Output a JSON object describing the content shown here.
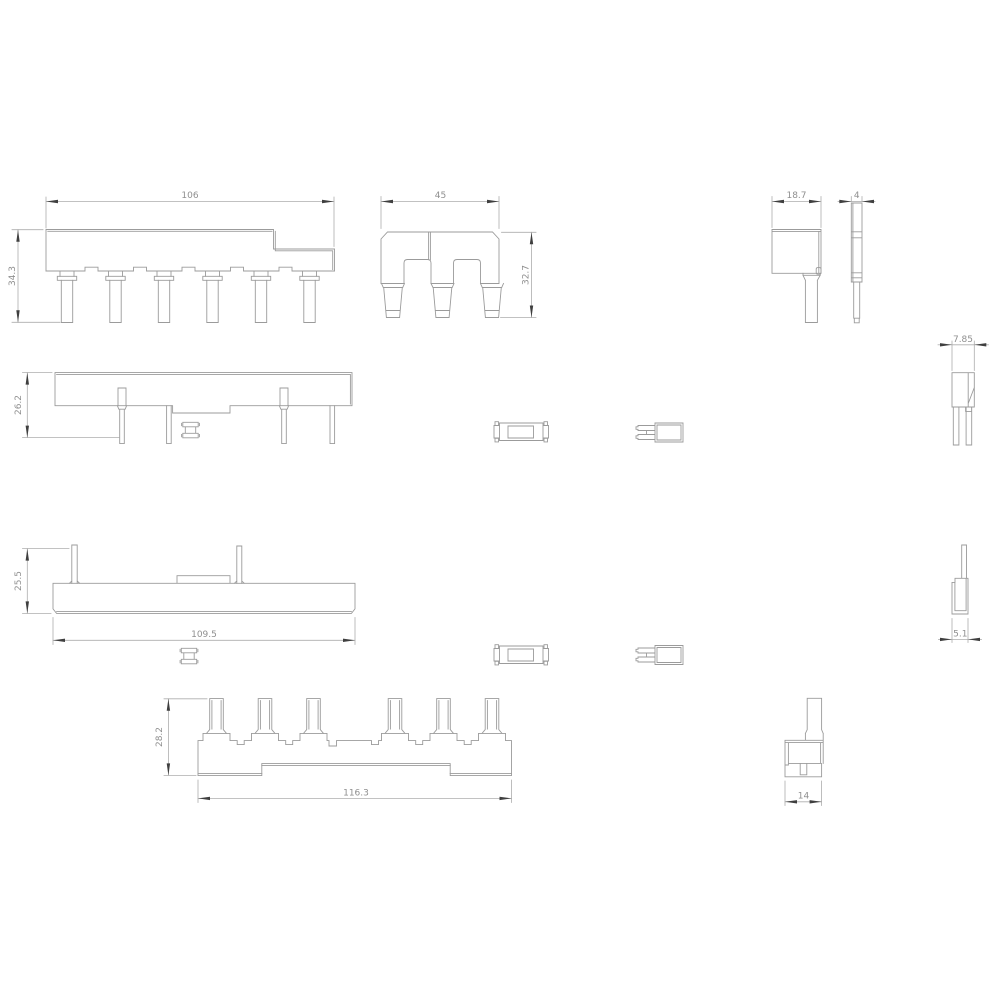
{
  "drawing": {
    "background": "#ffffff",
    "line_color": "#9b9b9b",
    "dim_line_color": "#adadad",
    "arrow_color": "#3f3f3f",
    "text_color": "#8f8f8f"
  },
  "views": {
    "busbar_front": {
      "width": "106",
      "height": "34.3"
    },
    "comb_side": {
      "width": "45",
      "height": "32.7"
    },
    "end_cap_side": {
      "width": "18.7"
    },
    "blade_profile": {
      "width": "4"
    },
    "fork_profile": {
      "width": "7.85"
    },
    "adapter_front": {
      "height": "26.2"
    },
    "lower_bar_front": {
      "height": "25.5",
      "width": "109.5"
    },
    "pin_profile": {
      "width": "5.1"
    },
    "bottom_bar_front": {
      "height": "28.2",
      "width": "116.3"
    },
    "foot_side": {
      "width": "14"
    }
  }
}
